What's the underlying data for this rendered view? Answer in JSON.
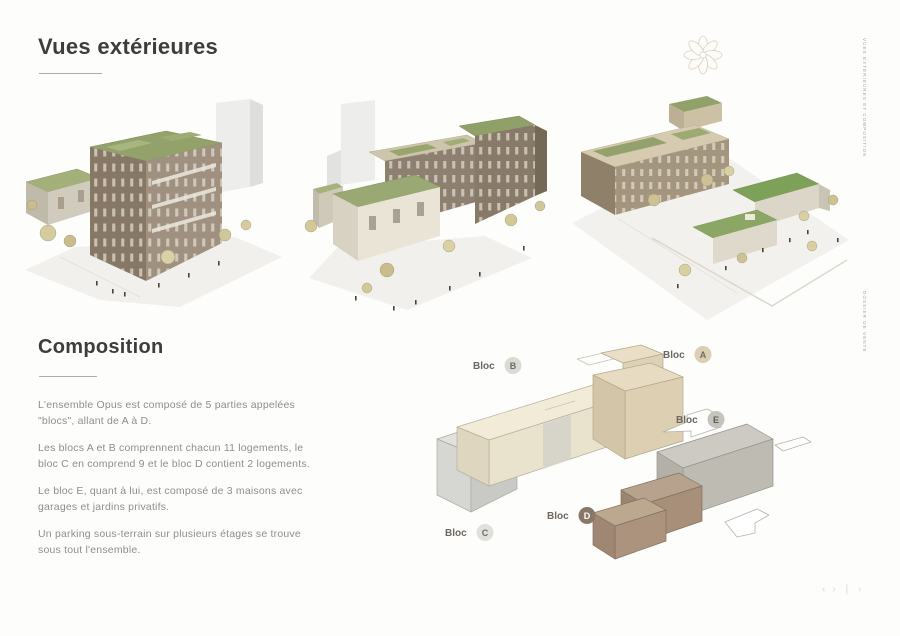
{
  "page": {
    "section1_title": "Vues extérieures",
    "section2_title": "Composition",
    "side_label_top": "VUES EXTÉRIEURES ET COMPOSITION",
    "side_label_bottom": "DOSSIER DE VENTE"
  },
  "composition": {
    "paragraphs": [
      "L'ensemble Opus est composé de 5 parties appelées \"blocs\", allant de A à D.",
      "Les blocs A et B comprennent chacun 11 logements, le bloc C en comprend 9 et le bloc D contient 2 logements.",
      "Le bloc E, quant à lui, est composé de 3 maisons avec garages et jardins privatifs.",
      "Un parking sous-terrain sur plusieurs étages se trouve sous tout l'ensemble."
    ]
  },
  "diagram": {
    "blocks": [
      {
        "label": "Bloc",
        "letter": "B",
        "badge_color": "#dcdad5",
        "letter_color": "#6f6b64",
        "block_color": "#f1ebd8"
      },
      {
        "label": "Bloc",
        "letter": "A",
        "badge_color": "#dbceb2",
        "letter_color": "#6f6b64",
        "block_color": "#e7dbc1"
      },
      {
        "label": "Bloc",
        "letter": "E",
        "badge_color": "#c6c3bc",
        "letter_color": "#5f5b54",
        "block_color": "#cdcac3"
      },
      {
        "label": "Bloc",
        "letter": "D",
        "badge_color": "#8b7765",
        "letter_color": "#ffffff",
        "block_color": "#b7a28d"
      },
      {
        "label": "Bloc",
        "letter": "C",
        "badge_color": "#e0e0dd",
        "letter_color": "#6f6b64",
        "block_color": "#e1e1de"
      }
    ]
  },
  "icons": {
    "rosette_ornament": "✾",
    "pager_prev": "‹",
    "pager_next": "›",
    "pager_divider": "❘"
  },
  "footer": {
    "pager": [
      "‹",
      "›",
      "❘",
      "›"
    ]
  },
  "colors": {
    "heading": "#3d3d3c",
    "body_text": "#8f8e8a",
    "rule": "#b3ab9d",
    "green_roof": "#93a26b",
    "brick_facade": "#8a7b68",
    "cream_block": "#f1ebd8",
    "tan_block": "#e7dbc1",
    "brown_block": "#b7a28d",
    "gray_block": "#cdcac3"
  }
}
